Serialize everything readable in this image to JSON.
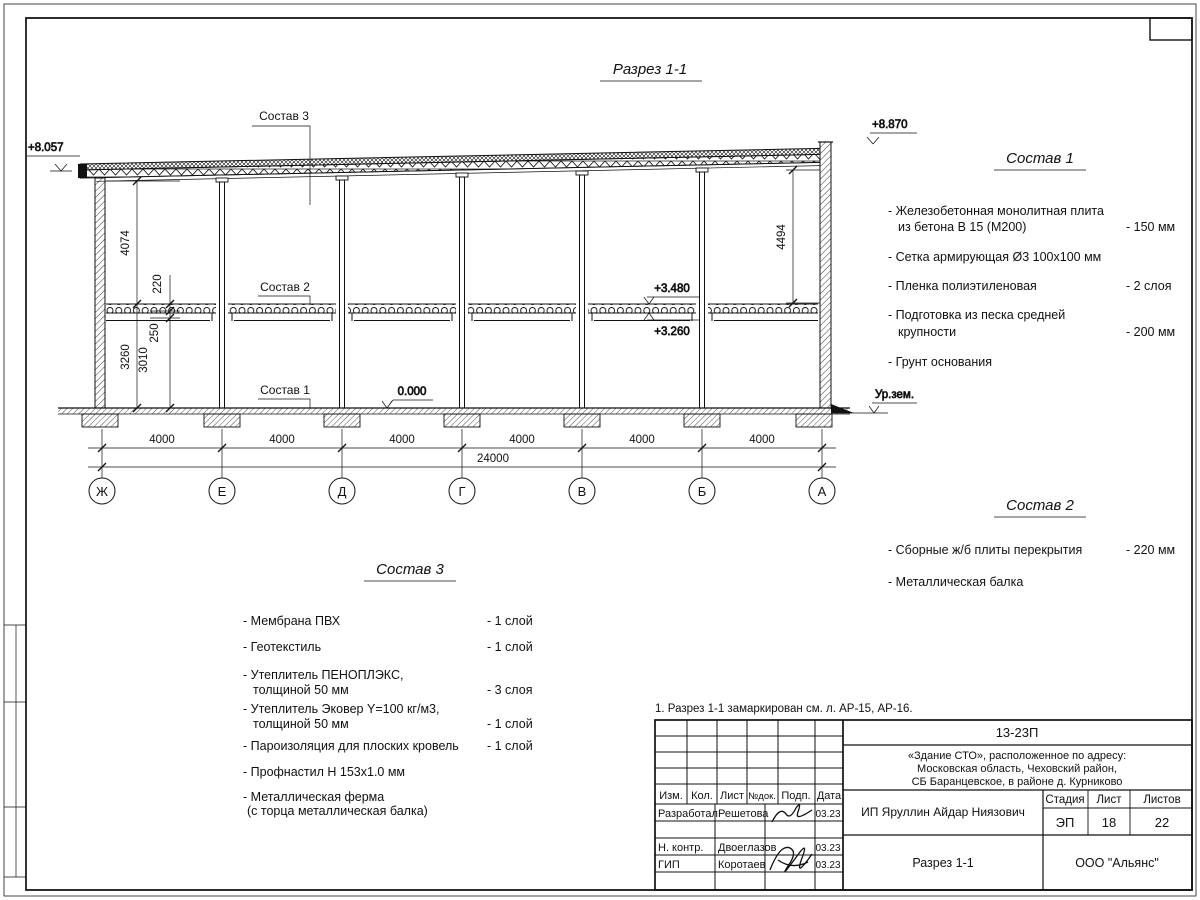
{
  "drawing": {
    "title": "Разрез 1-1",
    "elev_left": "+8.057",
    "elev_right": "+8.870",
    "elev_slab_top": "+3.480",
    "elev_slab_bot": "+3.260",
    "elev_floor": "0.000",
    "ground_label": "Ур.зем.",
    "dim_4074": "4074",
    "dim_220": "220",
    "dim_250": "250",
    "dim_3260": "3260",
    "dim_3010": "3010",
    "dim_4494": "4494",
    "spans": [
      "4000",
      "4000",
      "4000",
      "4000",
      "4000",
      "4000"
    ],
    "total": "24000",
    "axes": [
      "Ж",
      "Е",
      "Д",
      "Г",
      "В",
      "Б",
      "А"
    ],
    "callout1": "Состав 1",
    "callout2": "Состав 2",
    "callout3": "Состав 3"
  },
  "composition1": {
    "title": "Состав 1",
    "items": [
      {
        "line1": "- Железобетонная  монолитная плита",
        "line2": "из бетона В 15 (М200)",
        "value": "- 150 мм"
      },
      {
        "line1": "- Сетка армирующая Ø3 100х100 мм",
        "line2": "",
        "value": ""
      },
      {
        "line1": "- Пленка полиэтиленовая",
        "line2": "",
        "value": "-  2 слоя"
      },
      {
        "line1": "- Подготовка из песка средней",
        "line2": "крупности",
        "value": "- 200 мм"
      },
      {
        "line1": "- Грунт основания",
        "line2": "",
        "value": ""
      }
    ]
  },
  "composition2": {
    "title": "Состав 2",
    "items": [
      {
        "line1": "- Сборные ж/б плиты перекрытия",
        "value": "- 220 мм"
      },
      {
        "line1": "- Металлическая  балка",
        "value": ""
      }
    ]
  },
  "composition3": {
    "title": "Состав 3",
    "items": [
      {
        "line1": "- Мембрана ПВХ",
        "line2": "",
        "value": "- 1 слой"
      },
      {
        "line1": "- Геотекстиль",
        "line2": "",
        "value": "- 1 слой"
      },
      {
        "line1": "- Утеплитель ПЕНОПЛЭКС,",
        "line2": "толщиной 50 мм",
        "value": "- 3 слоя"
      },
      {
        "line1": "- Утеплитель Эковер Y=100 кг/м3,",
        "line2": "толщиной 50 мм",
        "value": "- 1 слой"
      },
      {
        "line1": "- Пароизоляция для плоских кровель",
        "line2": "",
        "value": "- 1 слой"
      },
      {
        "line1": "- Профнастил Н 153х1.0 мм",
        "line2": "",
        "value": ""
      },
      {
        "line1": "- Металлическая ферма",
        "line2": "(с торца металлическая балка)",
        "value": ""
      }
    ]
  },
  "note": "1. Разрез 1-1 замаркирован см. л. АР-15, АР-16.",
  "titleblock": {
    "code": "13-23П",
    "object_line1": "«Здание СТО», расположенное по адресу:",
    "object_line2": "Московская область, Чеховский район,",
    "object_line3": "СБ Баранцевское, в районе д. Курниково",
    "col_izm": "Изм.",
    "col_kol": "Кол.",
    "col_list": "Лист",
    "col_ndok": "№док.",
    "col_podp": "Подп.",
    "col_data": "Дата",
    "stage_label": "Стадия",
    "sheet_label": "Лист",
    "sheets_label": "Листов",
    "stage": "ЭП",
    "sheet_no": "18",
    "sheets_total": "22",
    "rows": [
      {
        "role": "Разработал",
        "name": "Решетова",
        "date": "03.23"
      },
      {
        "role": "Н. контр.",
        "name": "Двоеглазов",
        "date": "03.23"
      },
      {
        "role": "ГИП",
        "name": "Коротаев",
        "date": "03.23"
      }
    ],
    "company": "ИП Яруллин Айдар Ниязович",
    "doc_title": "Разрез 1-1",
    "org": "ООО \"Альянс\""
  }
}
